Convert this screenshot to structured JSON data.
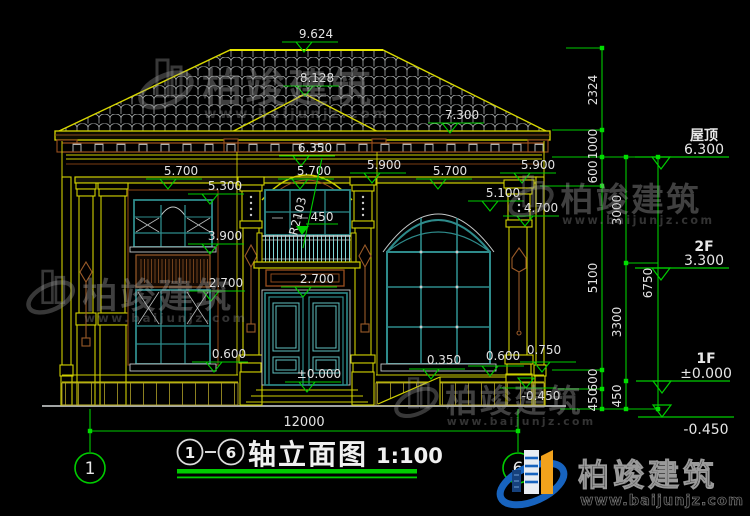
{
  "brand": {
    "name": "柏竣建筑",
    "url": "www.baijunjz.com"
  },
  "drawing_title": {
    "axis_left": "1",
    "axis_right": "6",
    "name": "轴立面图",
    "scale": "1:100"
  },
  "axis_bubbles": {
    "left": "1",
    "right": "6"
  },
  "floor_levels": {
    "roof_label": "屋顶",
    "roof_value": "6.300",
    "f2_label": "2F",
    "f2_value": "3.300",
    "f1_label": "1F",
    "f1_value": "±0.000",
    "ground_value": "-0.450"
  },
  "elevation_marks": {
    "peak": "9.624",
    "bay_peak": "8.128",
    "eave_right": "7.300",
    "arch_top": "6.350",
    "left_5900": "5.900",
    "left_5700": "5.700",
    "center_5700": "5.700",
    "right_5700": "5.700",
    "right_5900": "5.900",
    "left_5300": "5.300",
    "right_5100": "5.100",
    "right_4700": "4.700",
    "left_3900": "3.900",
    "left_2700": "2.700",
    "center_2700": "2.700",
    "left_0600": "0.600",
    "center_zero": "±0.000",
    "right_0350": "0.350",
    "right_0600": "0.600",
    "right_0750": "0.750",
    "right_neg0450": "-0.450"
  },
  "annotations": {
    "arch_radius": "R2103",
    "railing_height": "450"
  },
  "vertical_dims": {
    "seg_2324": "2324",
    "seg_1000": "1000",
    "seg_600_top": "600",
    "seg_5100": "5100",
    "seg_600_bottom": "600",
    "seg_450_a": "450",
    "seg_3000": "3000",
    "seg_3300": "3300",
    "seg_450_b": "450",
    "seg_6750": "6750"
  },
  "horizontal_dims": {
    "overall_width": "12000"
  }
}
